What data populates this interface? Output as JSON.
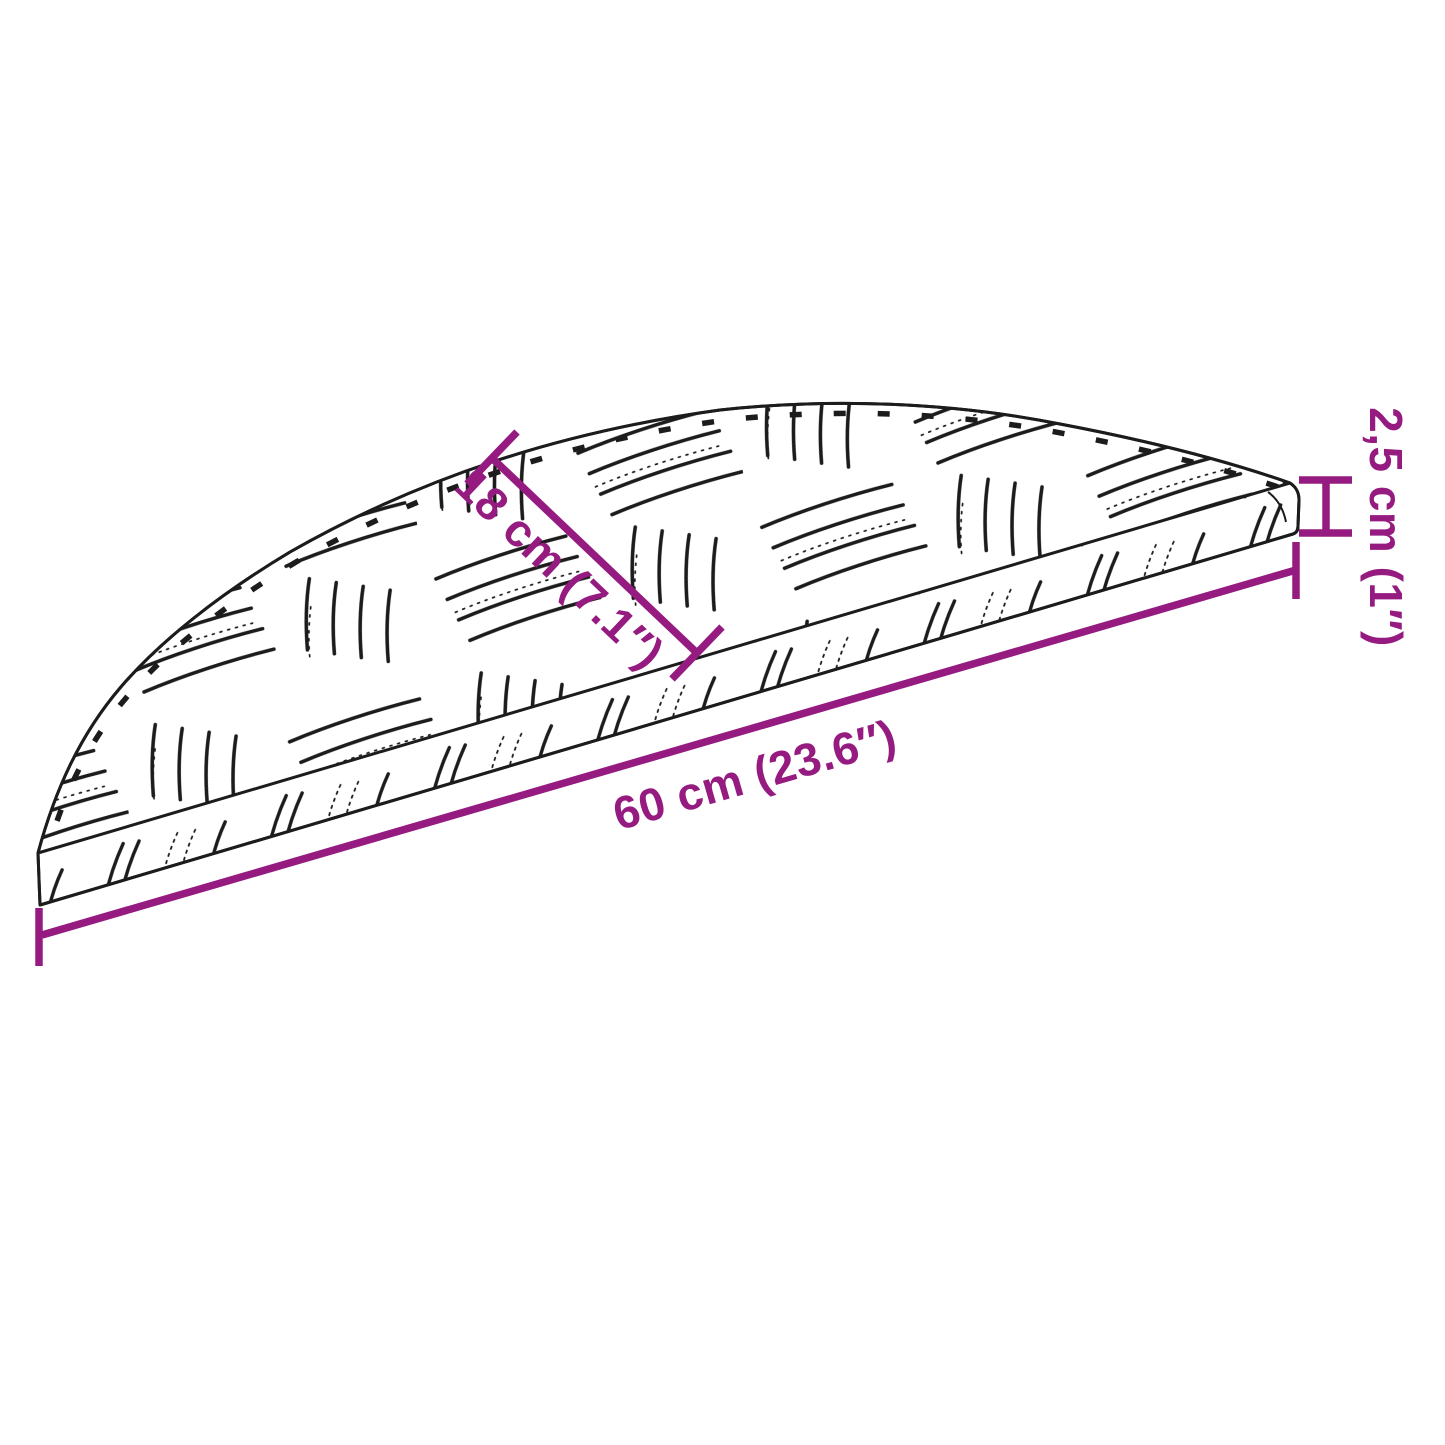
{
  "colors": {
    "accent": "#951B81",
    "ink": "#1C1C1C"
  },
  "dimensions": {
    "width_label": "60 cm (23.6″)",
    "depth_label": "18 cm (7.1″)",
    "thickness_label": "2,5 cm (1″)"
  }
}
